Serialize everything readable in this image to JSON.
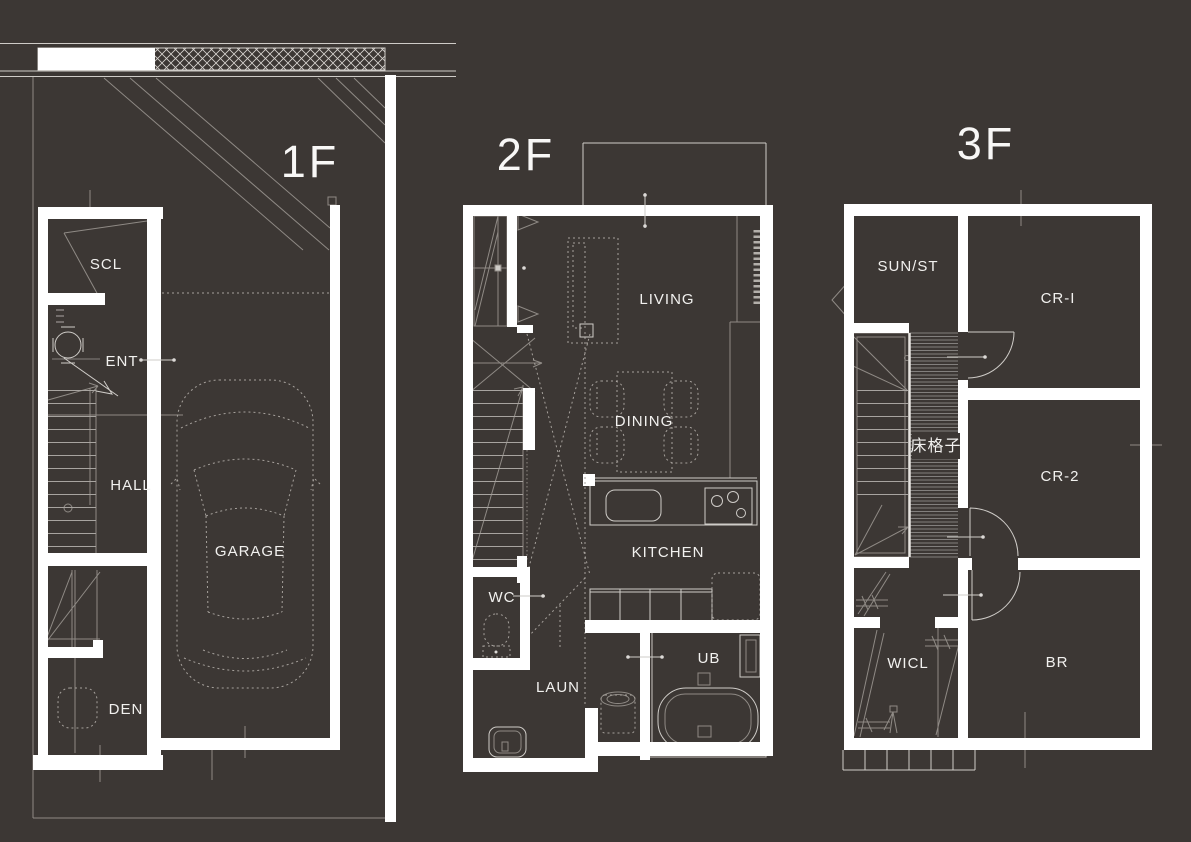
{
  "document": {
    "type": "architectural-floor-plan",
    "sheet_background": "#3c3734"
  },
  "colors": {
    "background": "#3c3734",
    "walls": "#ffffff",
    "thin_line": "#cfccc8",
    "dim_line": "#8f8a85",
    "dashed_furniture": "#a6a19c",
    "label_text": "#f2f1ef"
  },
  "floors": {
    "f1": {
      "label": "1F",
      "rooms": {
        "scl": "SCL",
        "ent": "ENT",
        "hall": "HALL",
        "garage": "GARAGE",
        "den": "DEN"
      }
    },
    "f2": {
      "label": "2F",
      "rooms": {
        "living": "LIVING",
        "dining": "DINING",
        "kitchen": "KITCHEN",
        "wc": "WC",
        "laun": "LAUN",
        "ub": "UB"
      }
    },
    "f3": {
      "label": "3F",
      "rooms": {
        "sunst": "SUN/ST",
        "cr1": "CR-I",
        "cr2": "CR-2",
        "grate": "床格子",
        "wicl": "WICL",
        "br": "BR"
      }
    }
  }
}
